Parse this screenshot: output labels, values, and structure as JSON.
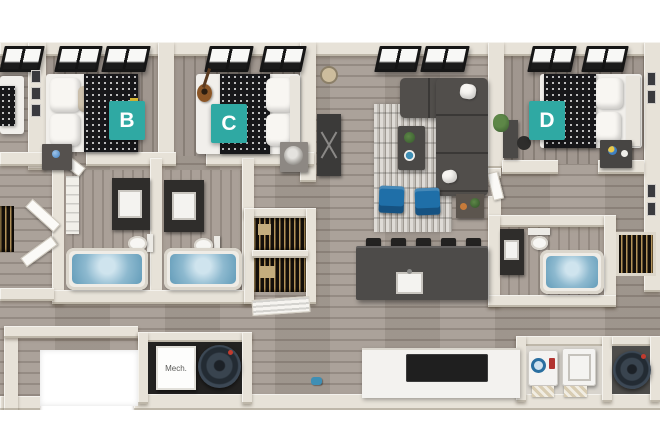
{
  "image": {
    "type": "3d-floor-plan",
    "background": "#FFFFFF"
  },
  "rooms": [
    {
      "id": "bedroom-b",
      "label": "B"
    },
    {
      "id": "bedroom-c",
      "label": "C"
    },
    {
      "id": "bedroom-d",
      "label": "D"
    }
  ],
  "mech": {
    "label": "Mech."
  },
  "colors": {
    "label_bg": "#2FA9A3",
    "label_text": "#FFFFFF",
    "wall": "#E7E2D8",
    "floor_main": "#A1978E",
    "floor_bedroom": "#9B9189",
    "water": "#8DB9CF",
    "sofa": "#514E4B",
    "accent_chair": "#1F6FA8",
    "island": "#4D4B49",
    "duvet": "#17171A",
    "window_frame": "#161616"
  }
}
